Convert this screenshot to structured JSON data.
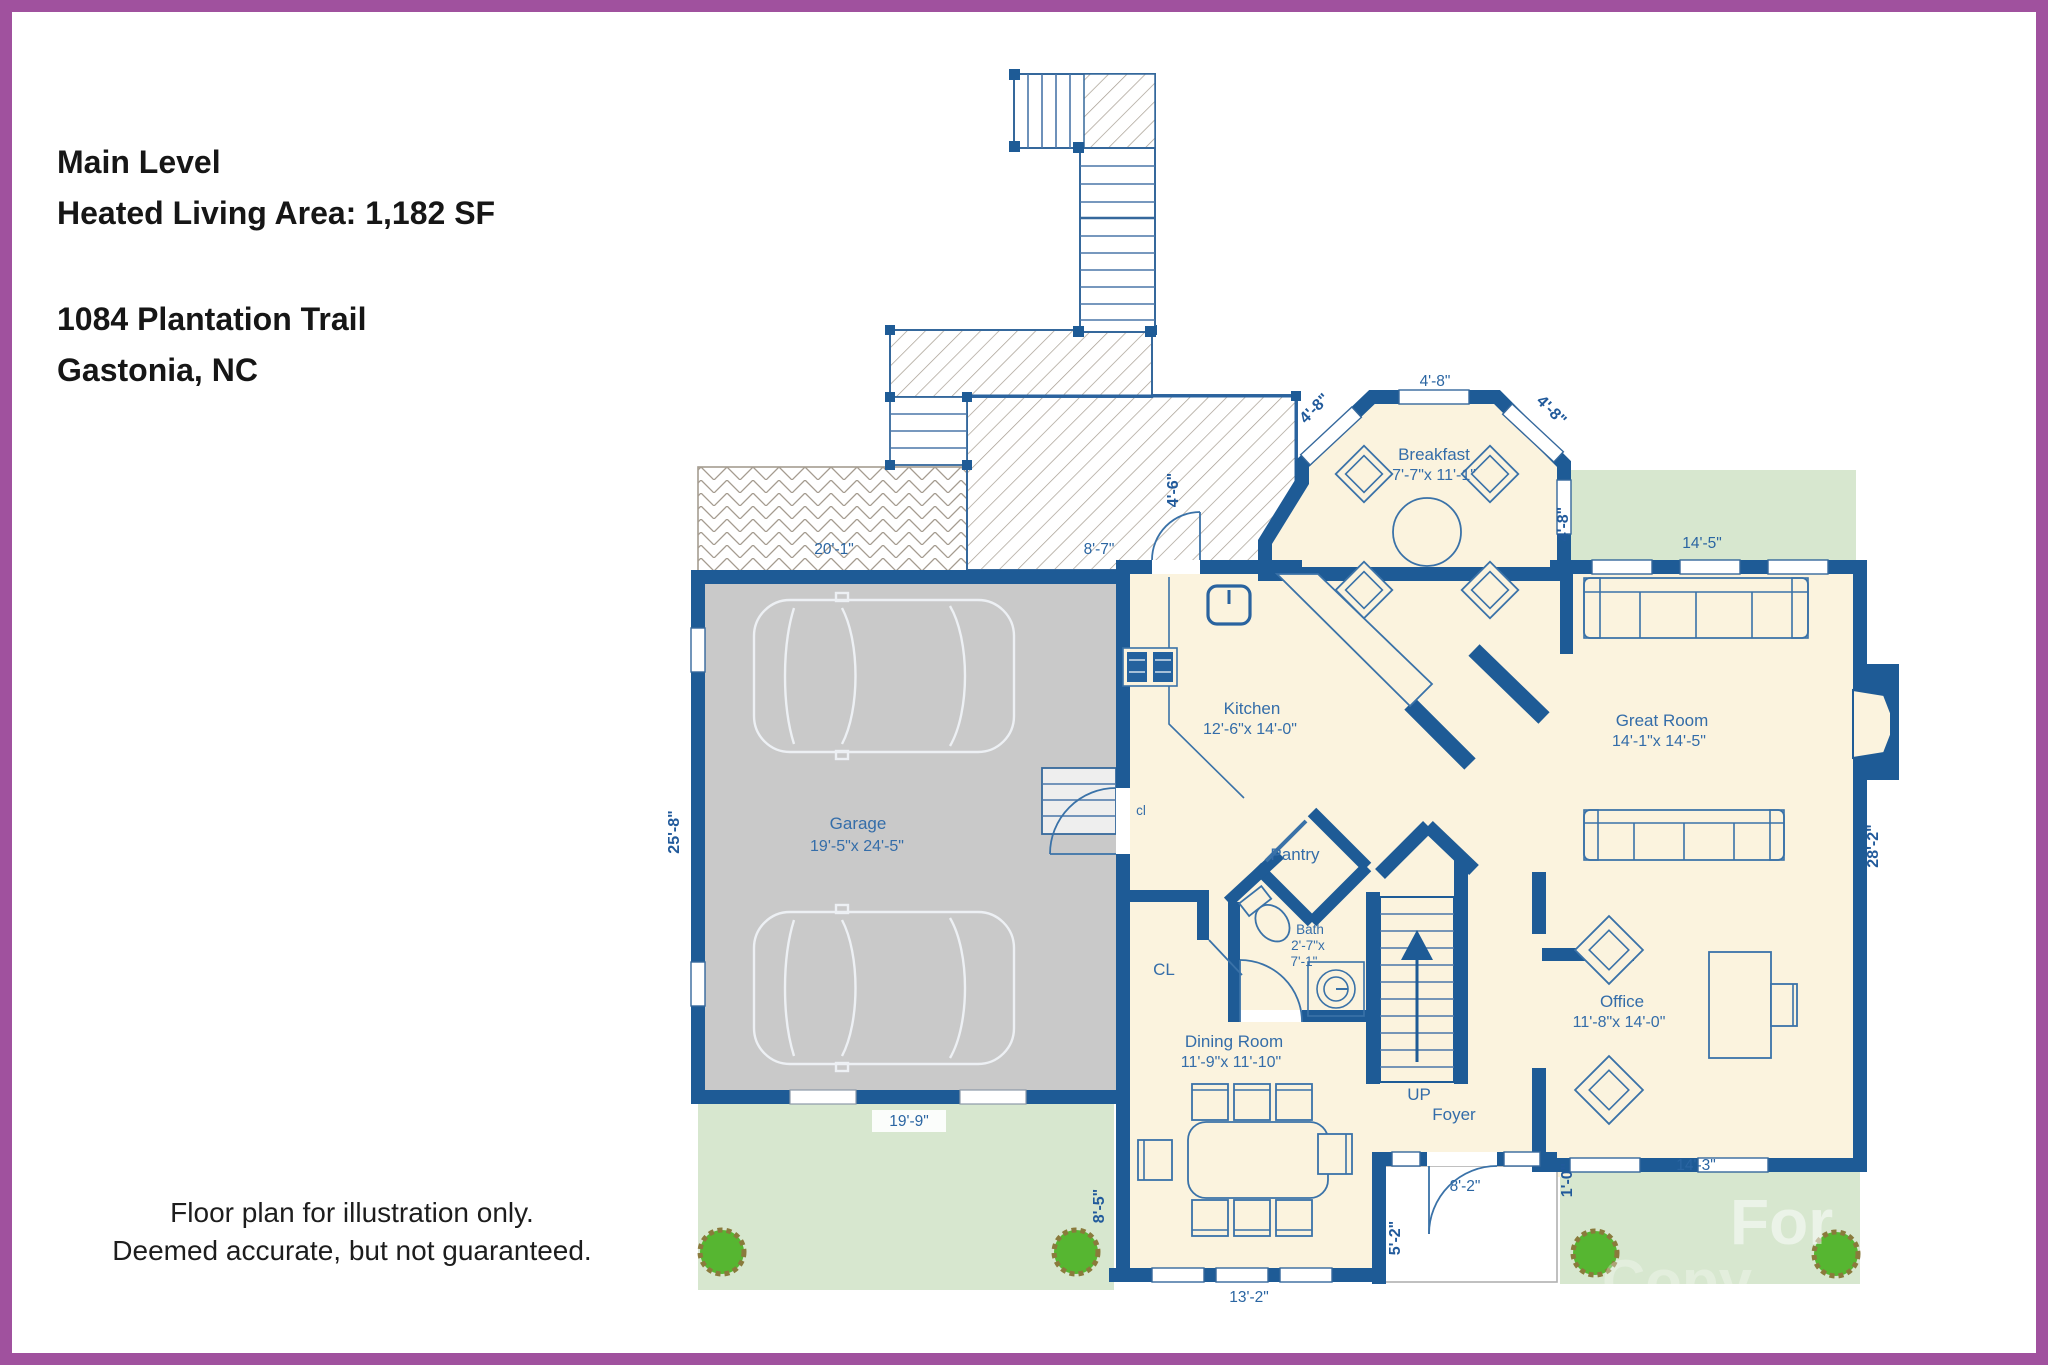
{
  "header": {
    "line1": "Main Level",
    "line2": "Heated Living Area: 1,182 SF",
    "address1": "1084 Plantation Trail",
    "address2": "Gastonia, NC"
  },
  "footer": {
    "line1": "Floor plan for illustration only.",
    "line2": "Deemed accurate, but not guaranteed."
  },
  "watermark": {
    "line1": "For",
    "line2": "Copy"
  },
  "rooms": {
    "breakfast": {
      "label": "Breakfast",
      "dims": "7'-7\"x 11'-1\""
    },
    "kitchen": {
      "label": "Kitchen",
      "dims": "12'-6\"x 14'-0\""
    },
    "great_room": {
      "label": "Great Room",
      "dims": "14'-1\"x 14'-5\""
    },
    "garage": {
      "label": "Garage",
      "dims": "19'-5\"x 24'-5\""
    },
    "dining": {
      "label": "Dining Room",
      "dims": "11'-9\"x 11'-10\""
    },
    "office": {
      "label": "Office",
      "dims": "11'-8\"x 14'-0\""
    },
    "pantry": {
      "label": "Pantry"
    },
    "bath": {
      "label": "Bath",
      "dims1": "2'-7\"x",
      "dims2": "7'-1\""
    },
    "foyer": {
      "label": "Foyer"
    },
    "stairs": {
      "label": "UP"
    },
    "closet_small": {
      "label": "cl"
    },
    "closet_hall": {
      "label": "CL"
    }
  },
  "dimensions": {
    "patio": "20'-1\"",
    "deck": "8'-7\"",
    "deck_door": "4'-6\"",
    "breakfast_top": "4'-8\"",
    "breakfast_left_diag": "4'-8\"",
    "breakfast_right_diag": "4'-8\"",
    "breakfast_side": "4'-8\"",
    "lawn_top_right": "14'-5\"",
    "garage_side": "25'-8\"",
    "garage_front": "19'-9\"",
    "dining_side": "8'-5\"",
    "dining_front": "13'-2\"",
    "porch_side": "5'-2\"",
    "entry_door": "8'-2\"",
    "porch_offset": "1'-0\"",
    "office_front": "14'-3\"",
    "great_room_side": "28'-2\""
  },
  "colors": {
    "border": "#a0519e",
    "walls": "#1e5b96",
    "floor": "#fbf3de",
    "garage_floor": "#c9c9c9",
    "lawn": "#d7e7cf",
    "bush": "#56b631",
    "bush_edge": "#8a7a3c",
    "line_blue": "#3a72a8",
    "label_text": "#346da9",
    "hatch": "#a59c90"
  }
}
